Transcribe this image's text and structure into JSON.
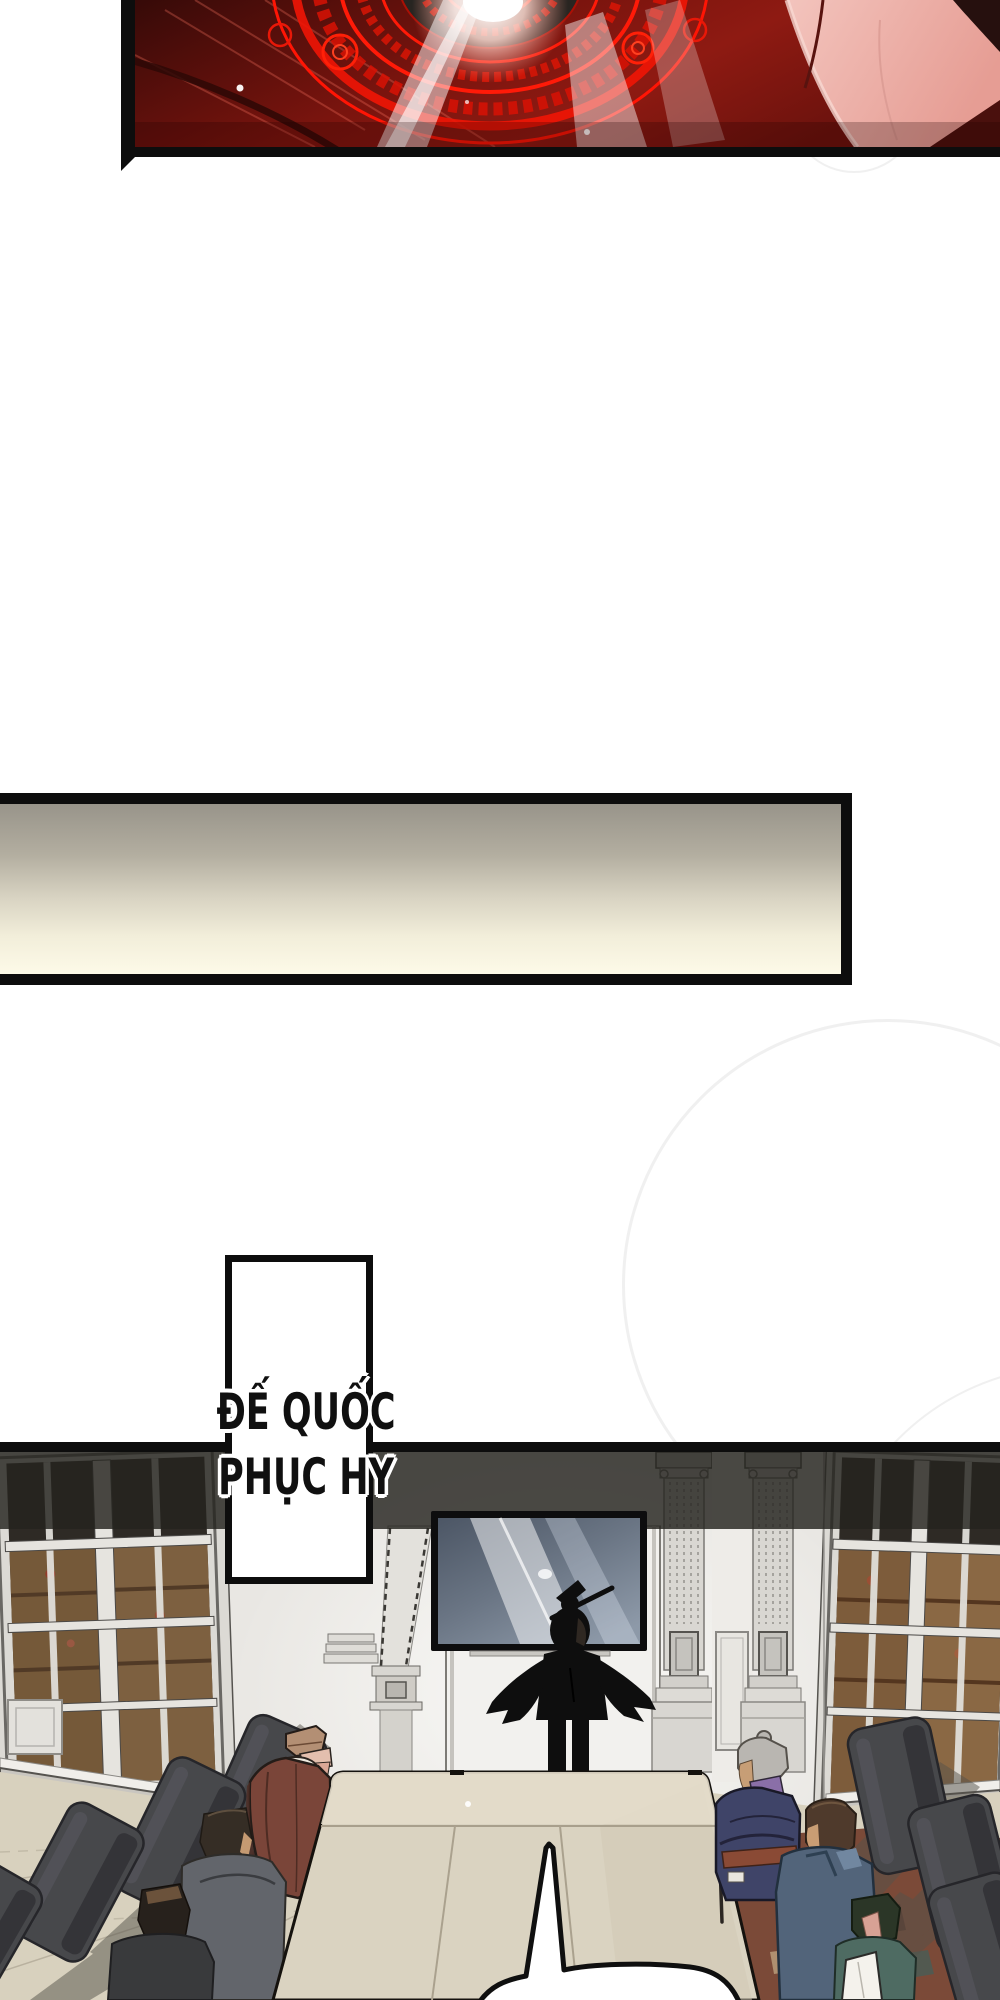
{
  "title_box": {
    "line1": "ĐẾ QUỐC",
    "line2": "PHỤC HY"
  },
  "colors": {
    "page_bg": "#ffffff",
    "ink": "#0d0d0d",
    "magic_red": "#ff1a08",
    "magic_floor": "#7a140e",
    "robe_pink": "#eeb3ad",
    "bar_top": "#98948a",
    "bar_cream": "#fdfae8",
    "wall": "#e9e7e3",
    "shadow_band": "#25231f",
    "tv_screen": "#5f6a78",
    "floor": "#d8d1be",
    "table": "#dad3c1",
    "table_light": "#e3dcca",
    "chair": "#47484b",
    "carpet": "#7b4a38",
    "elder_brown": "#7a4539",
    "elder_navy": "#3f4468",
    "belt_red": "#8a4a35",
    "coat_blue": "#52647a",
    "coat_green": "#4e6b62",
    "suit_black": "#0e0e0e",
    "hair_gray": "#b9b6b1",
    "title_ink": "#101010"
  }
}
